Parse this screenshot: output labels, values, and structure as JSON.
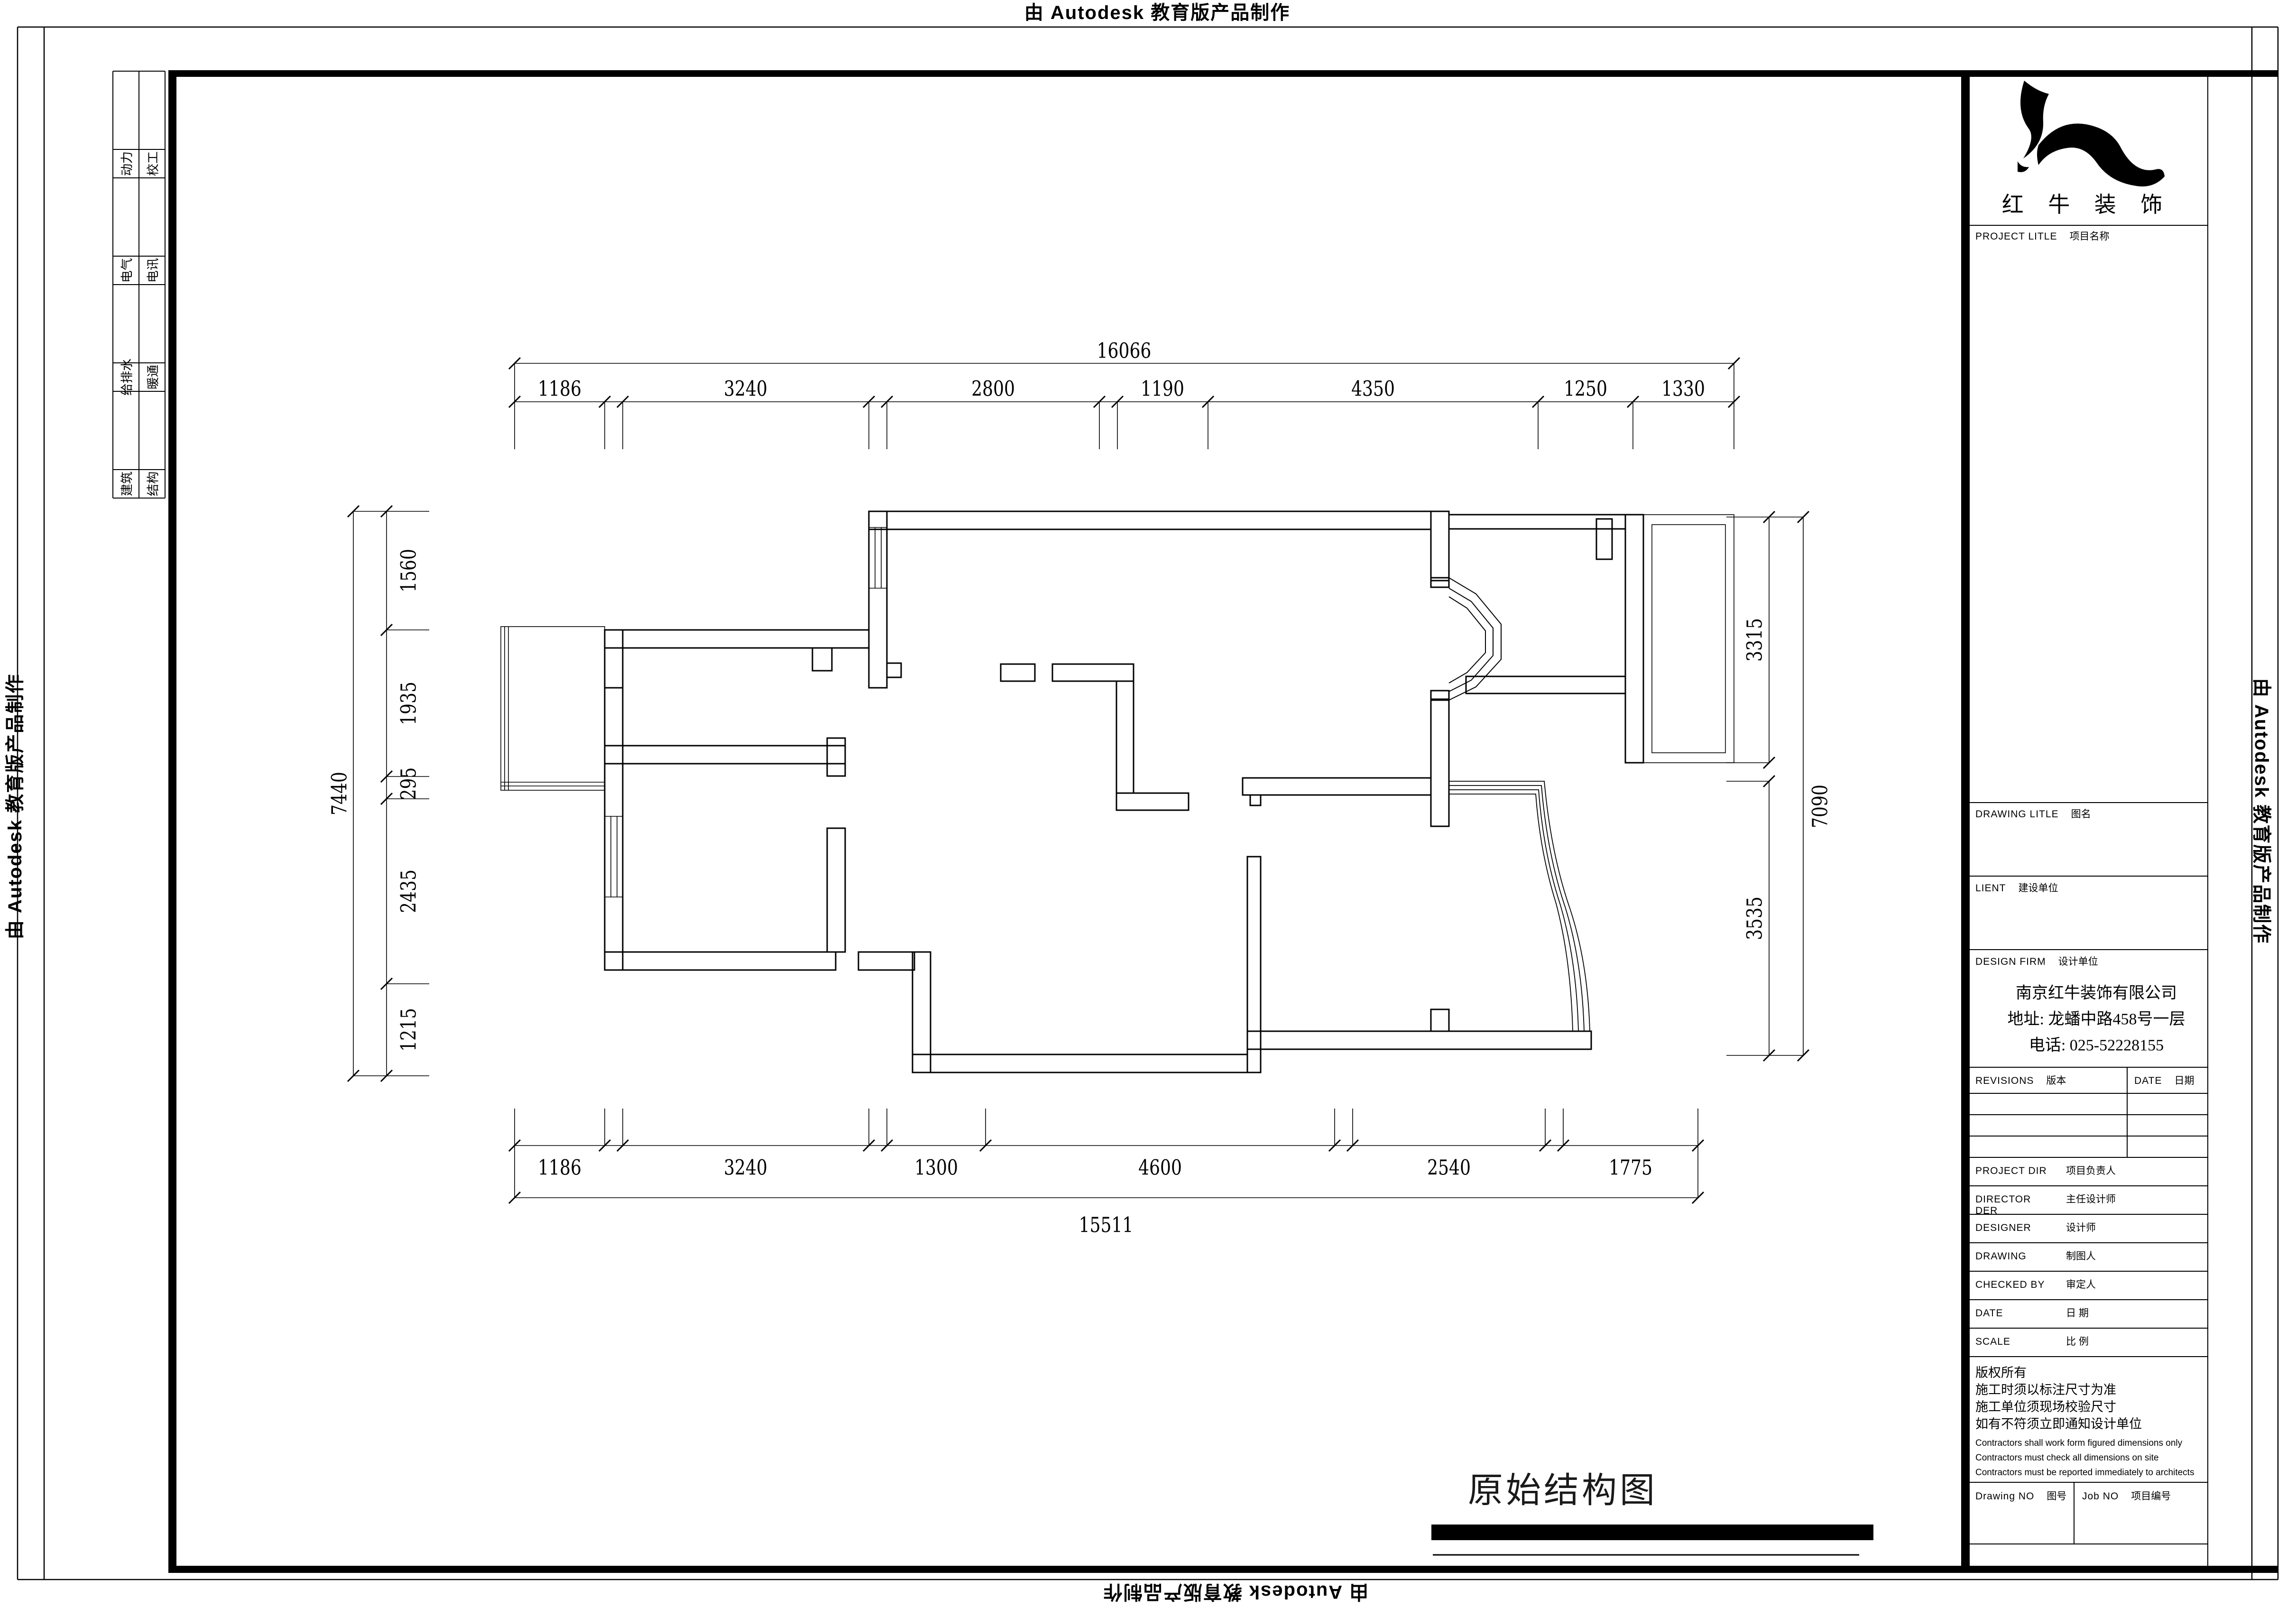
{
  "colors": {
    "ink": "#000000",
    "paper": "#ffffff"
  },
  "border": {
    "stamp": "由 Autodesk 教育版产品制作"
  },
  "sign_strip": {
    "rows": [
      [
        "动力",
        "校工"
      ],
      [
        "电气",
        "电讯"
      ],
      [
        "给排水",
        "暖通"
      ],
      [
        "建筑",
        "结构"
      ]
    ]
  },
  "drawing": {
    "title": "原始结构图"
  },
  "dims": {
    "top": {
      "total": "16066",
      "segments": [
        "1186",
        "3240",
        "2800",
        "1190",
        "4350",
        "1250",
        "1330"
      ]
    },
    "bottom": {
      "total": "15511",
      "segments": [
        "1186",
        "3240",
        "1300",
        "4600",
        "2540",
        "1775"
      ]
    },
    "left": {
      "total": "7440",
      "segments": [
        "1560",
        "1935",
        "295",
        "2435",
        "1215"
      ]
    },
    "right": {
      "total": "7090",
      "segments": [
        "3315",
        "3535"
      ]
    }
  },
  "title_block": {
    "brand": "红 牛 装 饰",
    "project": {
      "en": "PROJECT LITLE",
      "cn": "项目名称"
    },
    "drawing_title_label": {
      "en": "DRAWING LITLE",
      "cn": "图名"
    },
    "client": {
      "en": "LIENT",
      "cn": "建设单位"
    },
    "design_firm": {
      "en": "DESIGN FIRM",
      "cn": "设计单位"
    },
    "company": [
      "南京红牛装饰有限公司",
      "地址: 龙蟠中路458号一层",
      "电话: 025-52228155"
    ],
    "revisions": {
      "en": "REVISIONS",
      "cn": "版本"
    },
    "date_col": {
      "en": "DATE",
      "cn": "日期"
    },
    "fields": [
      {
        "en": "PROJECT DIR",
        "cn": "项目负责人"
      },
      {
        "en": "DIRECTOR DER",
        "cn": "主任设计师"
      },
      {
        "en": "DESIGNER",
        "cn": "设计师"
      },
      {
        "en": "DRAWING",
        "cn": "制图人"
      },
      {
        "en": "CHECKED BY",
        "cn": "审定人"
      },
      {
        "en": "DATE",
        "cn": "日  期"
      },
      {
        "en": "SCALE",
        "cn": "比  例"
      }
    ],
    "notes_cn": [
      "版权所有",
      "施工时须以标注尺寸为准",
      "施工单位须现场校验尺寸",
      "如有不符须立即通知设计单位"
    ],
    "notes_en": [
      "Contractors shall work form figured dimensions only",
      "Contractors must check all dimensions on site",
      "Contractors must be reported immediately to architects"
    ],
    "drawing_no": {
      "en": "Drawing NO",
      "cn": "图号"
    },
    "job_no": {
      "en": "Job NO",
      "cn": "项目编号"
    }
  }
}
